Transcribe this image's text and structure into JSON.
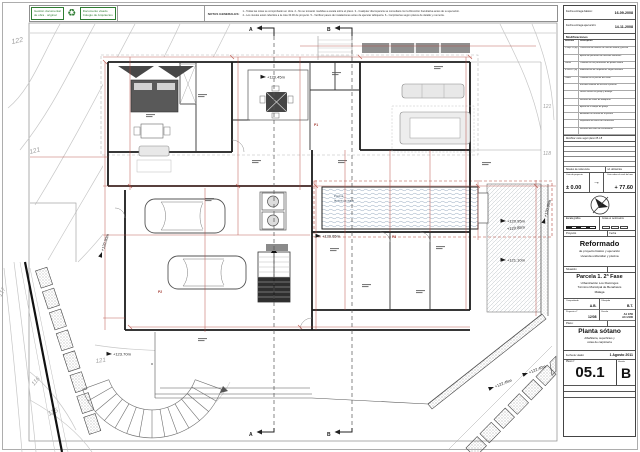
{
  "stamps": {
    "box1_line1": "Gestión documental",
    "box1_line2": "de obra · original",
    "recycle_icon": "♻",
    "box2_line1": "Documento visado",
    "box2_line2": "Colegio de Arquitectos"
  },
  "notes": {
    "title": "NOTAS GENERALES:",
    "line1": "1.- Todas las cotas se comprobarán en obra. 2.- No se tomarán medidas a escala sobre el plano. 3.- Cualquier discrepancia se consultará con la Dirección Facultativa antes de su ejecución.",
    "line2": "4.- Los niveles están referidos a la cota ±0.00 de proyecto. 5.- Verificar pasos de instalaciones antes de ejecutar tabiquería. 6.- Carpinterías según planos de detalle y memoria."
  },
  "titleblock": {
    "date1_label": "Fecha entrega básico:",
    "date1_value": "16-09-2008",
    "date2_label": "Fecha entrega ejecución:",
    "date2_value": "14-11-2008",
    "mods_title": "Modificaciones",
    "mods_col1": "Revisión",
    "mods_col2": "Descripción",
    "mods_rows": [
      {
        "rev": "1-Sep-11 (A)",
        "desc": "Corrección de niveles en cota de sótano y piscina"
      },
      {
        "rev": "",
        "desc": "Ajuste del perímetro de terrazas exteriores"
      },
      {
        "rev": "Varios",
        "desc": "Cambios en las particiones de planta sótano"
      },
      {
        "rev": "4-Jun-12 (B)",
        "desc": "Modificación de carpinterías según memoria"
      },
      {
        "rev": "Todos",
        "desc": "Cambios en el porche del salón"
      },
      {
        "rev": "",
        "desc": "Escalera exterior de acceso a parcela"
      },
      {
        "rev": "",
        "desc": "Nueva solera en garaje y bodega"
      },
      {
        "rev": "",
        "desc": "Revisión de cotas de tabiquería"
      },
      {
        "rev": "",
        "desc": "Ajuste de la rampa de garaje"
      },
      {
        "rev": "",
        "desc": "Acabados en terraza de la piscina"
      },
      {
        "rev": "",
        "desc": "Replanteo de muros de contención"
      },
      {
        "rev": "",
        "desc": "Revisión del muro de cerramiento"
      }
    ],
    "mods_note": "Rectificar cotas según plano 05.1 B",
    "levels_header": "Niveles de referencia",
    "levels_header_right": "ref. altimétrica",
    "ref_label": "Cota de proyecto",
    "ref_value": "± 0.00",
    "arrow": "→",
    "sea_label": "Cota sobre el nivel del mar",
    "sea_value": "+ 77.60",
    "scale_label": "Escala gráfica",
    "units_label": "Cotas en centímetros",
    "project_label": "Proyecto",
    "project_right": "Fecha",
    "project_title": "Reformado",
    "project_sub1": "de proyecto básico y ejecución",
    "project_sub2": "vivienda unifamiliar y piscina",
    "location_label": "Situación",
    "location_line1": "Parcela 1. 2ª Fase",
    "location_line2": "Urbanización Los Flamingos",
    "location_line3": "Término Municipal de Benahavís",
    "location_line4": "Málaga",
    "checked_label": "Comprobado",
    "checked_value": "A.B.",
    "drawn_label": "Dibujado",
    "drawn_value": "B.T.",
    "projnum_label": "Proyecto nº",
    "projnum_value": "12/08",
    "scalecell_label": "Escala",
    "scale_a1": "A1 1/50",
    "scale_a3": "A3 1/100",
    "plan_label": "Plano:",
    "plan_title": "Planta sótano",
    "plan_sub1": "Albañilería, superficies y",
    "plan_sub2": "cotas de carpintería",
    "visa_label": "Fecha de visado:",
    "visa_value": "1 Agosto 2011",
    "num_label": "Plano nº",
    "num_value": "05.1",
    "version_label": "Versión",
    "version_value": "B"
  },
  "plan": {
    "contour_labels": [
      "122",
      "121",
      "117",
      "116",
      "115",
      "121",
      "121",
      "118"
    ],
    "level_labels": [
      "+120.45m",
      "+120.90m",
      "+120.65m",
      "+120.95m",
      "+120.85m",
      "+121.10m",
      "+120.95m",
      "+123.70m",
      "+122.45m",
      "+122.40m"
    ],
    "section_a": "A",
    "section_b": "B",
    "pool_name": "Piscina",
    "pool_sub": "lámina de agua",
    "door_labels": [
      "P1",
      "P2",
      "P3"
    ]
  }
}
